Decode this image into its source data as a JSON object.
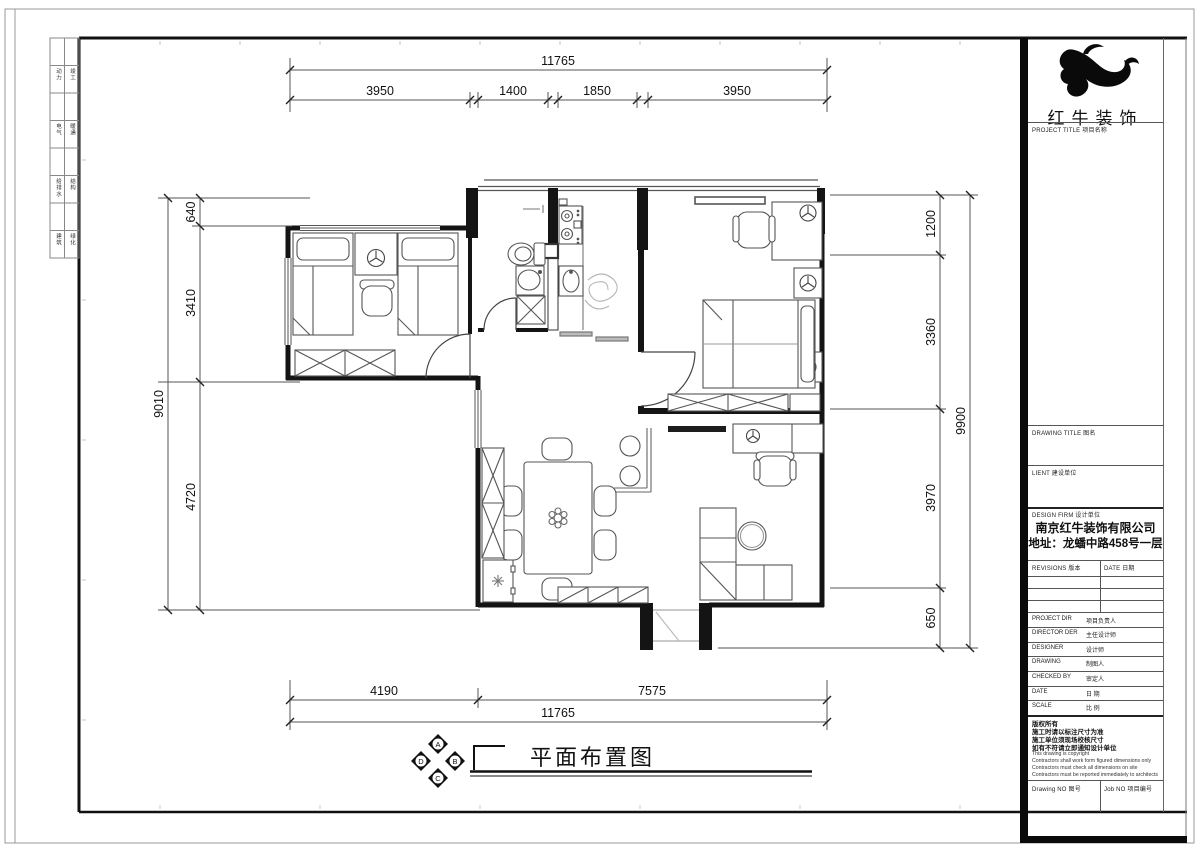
{
  "sheet": {
    "logo_name": "红牛装饰",
    "fields": {
      "project_title": "PROJECT TITLE  项目名称",
      "drawing_title": "DRAWING TITLE  图名",
      "client": "LIENT  建设单位",
      "design_firm": "DESIGN FIRM  设计单位",
      "firm_name": "南京红牛装饰有限公司",
      "firm_address": "地址：龙蟠中路458号一层",
      "revisions": "REVISIONS  版本",
      "date_col": "DATE  日期",
      "drawing_no": "Drawing NO  图号",
      "job_no": "Job NO  项目编号"
    },
    "personnel_rows": [
      {
        "en": "PROJECT DIR",
        "zh": "项目负责人"
      },
      {
        "en": "DIRECTOR DER",
        "zh": "主任设计师"
      },
      {
        "en": "DESIGNER",
        "zh": "设计师"
      },
      {
        "en": "DRAWING",
        "zh": "制图人"
      },
      {
        "en": "CHECKED BY",
        "zh": "审定人"
      },
      {
        "en": "DATE",
        "zh": "日  期"
      },
      {
        "en": "SCALE",
        "zh": "比  例"
      }
    ],
    "copyright_zh": [
      "版权所有",
      "施工时请以标注尺寸为准",
      "施工单位须现场校核尺寸",
      "如有不符请立即通知设计单位"
    ],
    "copyright_en": [
      "This drawing is copyright",
      "Contractors shall work form figured dimensions only",
      "Contractors must check all dimensions on site",
      "Contractors must be reported immediately to architects"
    ],
    "signoff_rows": [
      [
        "动力",
        "竣工"
      ],
      [
        "电气",
        "暖通"
      ],
      [
        "给排水",
        "结构"
      ],
      [
        "建筑",
        "绿化"
      ]
    ]
  },
  "plan": {
    "title": "平面布置图",
    "marker_letters": {
      "top": "A",
      "right": "B",
      "bottom": "C",
      "left": "D"
    },
    "dims": {
      "top_total": "11765",
      "top_segs": [
        "3950",
        "1400",
        "1850",
        "3950"
      ],
      "left_total": "9010",
      "left_segs": [
        "640",
        "3410",
        "4720"
      ],
      "right_total": "9900",
      "right_segs": [
        "1200",
        "3360",
        "3970",
        "650"
      ],
      "bottom_segs": [
        "4190",
        "7575"
      ],
      "bottom_total": "11765"
    }
  }
}
